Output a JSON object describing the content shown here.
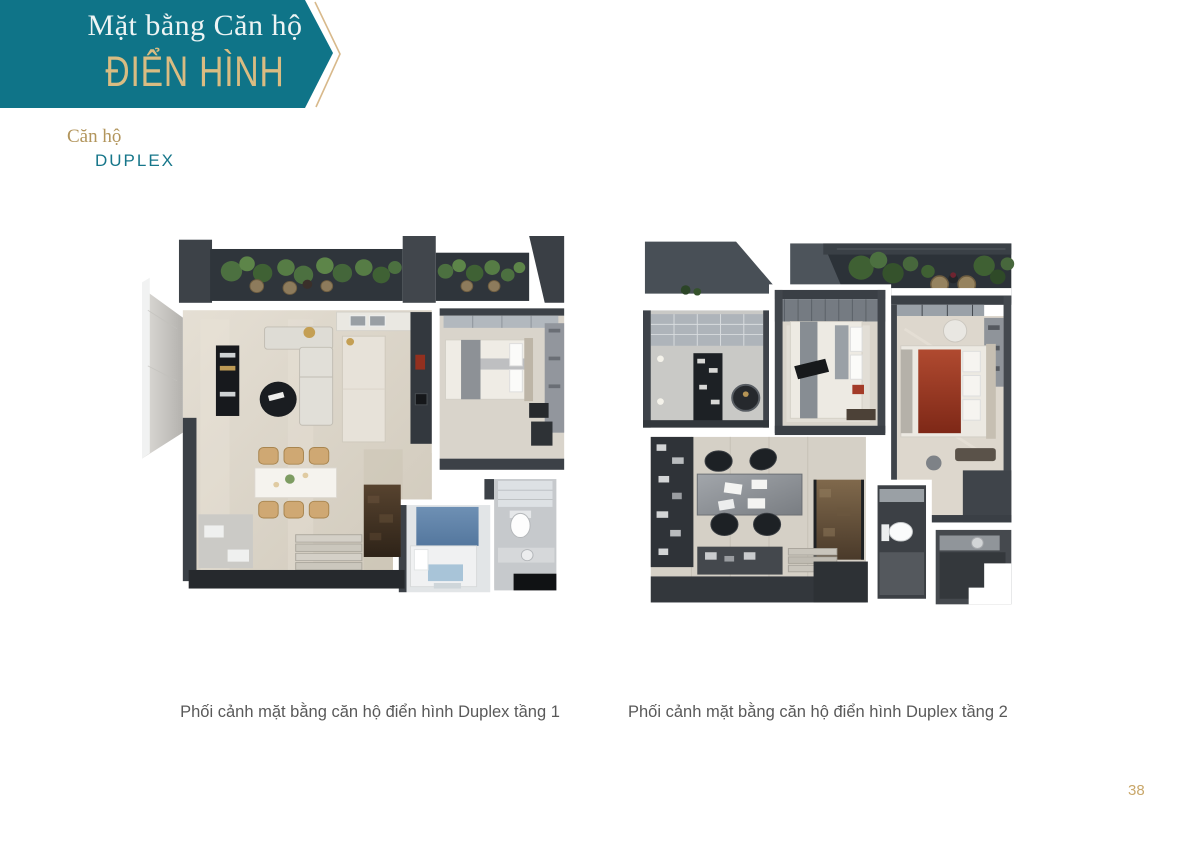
{
  "banner": {
    "title": "Mặt bằng Căn hộ",
    "subtitle": "ĐIỂN HÌNH"
  },
  "section": {
    "category": "Căn hộ",
    "type": "DUPLEX"
  },
  "figures": [
    {
      "caption": "Phối cảnh mặt bằng căn hộ điển hình Duplex tầng 1"
    },
    {
      "caption": "Phối cảnh mặt bằng căn hộ điển hình Duplex tầng 2"
    }
  ],
  "page_number": "38",
  "colors": {
    "banner_teal": "#0f7488",
    "banner_text": "#edf4f4",
    "accent_gold": "#d9bc82",
    "label_gold": "#b2955c",
    "label_teal": "#16768a",
    "caption_gray": "#595959",
    "page_number_gold": "#c9a76a"
  }
}
